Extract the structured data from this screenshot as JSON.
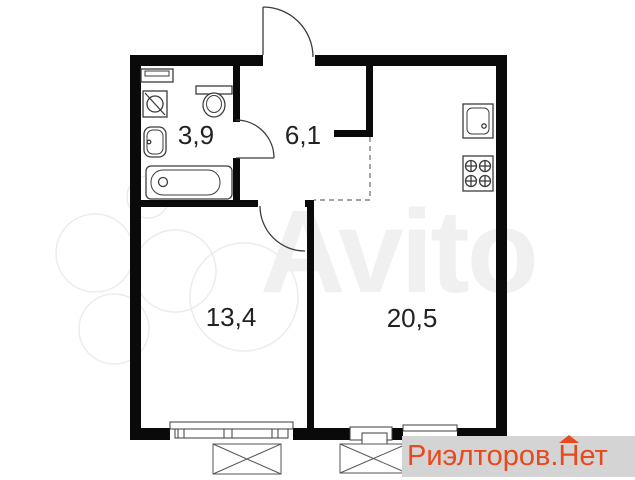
{
  "colors": {
    "background": "#ffffff",
    "wall": "#0a0a0a",
    "line": "#3c3c3c",
    "label_text": "#222222",
    "watermark_gray": "#f0f0f0",
    "watermark_stroke": "#ececec",
    "logo_orange": "#e8491d",
    "logo_band_gray": "#d4d4d4"
  },
  "floorplan": {
    "rooms": {
      "bathroom": {
        "area_label": "3,9"
      },
      "hallway": {
        "area_label": "6,1"
      },
      "living_room": {
        "area_label": "13,4"
      },
      "kitchen_living_room": {
        "area_label": "20,5"
      }
    }
  },
  "watermark": {
    "text": "Avito"
  },
  "logo": {
    "prefix": "Риэлторов.",
    "house_letter": "Н",
    "suffix": "ет"
  }
}
